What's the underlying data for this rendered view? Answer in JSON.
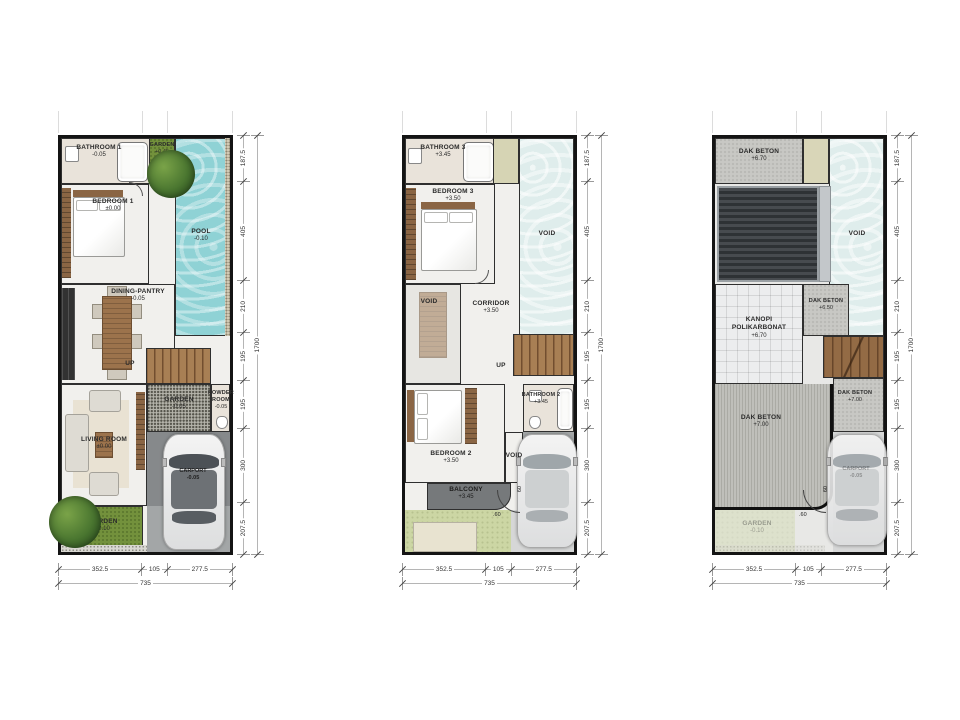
{
  "dimensions": {
    "right_segments": [
      "187.5",
      "405",
      "210",
      "195",
      "195",
      "300",
      "207.5"
    ],
    "right_total": "1700",
    "bottom_segments": [
      "352.5",
      "105",
      "277.5"
    ],
    "bottom_total": "735",
    "gate_offset_h": ".60",
    "gate_offset_v": "60"
  },
  "floor1": {
    "bathroom1": {
      "name": "BATHROOM 1",
      "level": "-0.05"
    },
    "garden_top": {
      "name": "GARDEN",
      "level": "+0.45"
    },
    "pool": {
      "name": "POOL",
      "level": "-0.10"
    },
    "bedroom1": {
      "name": "BEDROOM 1",
      "level": "±0.00"
    },
    "dining_pantry": {
      "name": "DINING-PANTRY",
      "level": "-0.05"
    },
    "stairs_label": "UP",
    "garden_mid": {
      "name": "GARDEN",
      "level": "-0.05"
    },
    "powder_room": {
      "name": "POWDER ROOM",
      "level": "-0.05"
    },
    "living_room": {
      "name": "LIVING ROOM",
      "level": "±0.00"
    },
    "carport": {
      "name": "CARPORT",
      "level": "-0.05"
    },
    "garden_bottom": {
      "name": "GARDEN",
      "level": "-0.10"
    }
  },
  "floor2": {
    "bathroom3": {
      "name": "BATHROOM 3",
      "level": "+3.45"
    },
    "bedroom3": {
      "name": "BEDROOM 3",
      "level": "+3.50"
    },
    "void_right": "VOID",
    "void_left": "VOID",
    "corridor": {
      "name": "CORRIDOR",
      "level": "+3.50"
    },
    "stairs_label": "UP",
    "bathroom2": {
      "name": "BATHROOM 2",
      "level": "+3.45"
    },
    "bedroom2": {
      "name": "BEDROOM 2",
      "level": "+3.50"
    },
    "void_small": "VOID",
    "balcony": {
      "name": "BALCONY",
      "level": "+3.45"
    }
  },
  "roof": {
    "dak_beton_top": {
      "name": "DAK BETON",
      "level": "+6.70"
    },
    "void_right": "VOID",
    "dak_beton_mid": {
      "name": "DAK BETON",
      "level": "+6.50"
    },
    "kanopi": {
      "line1": "KANOPI",
      "line2": "POLIKARBONAT",
      "level": "+6.70"
    },
    "dak_beton_right": {
      "name": "DAK BETON",
      "level": "+7.00"
    },
    "dak_beton_left": {
      "name": "DAK BETON",
      "level": "+7.00"
    },
    "garden": {
      "name": "GARDEN",
      "level": "-0.10"
    },
    "carport": {
      "name": "CARPORT",
      "level": "-0.05"
    }
  }
}
